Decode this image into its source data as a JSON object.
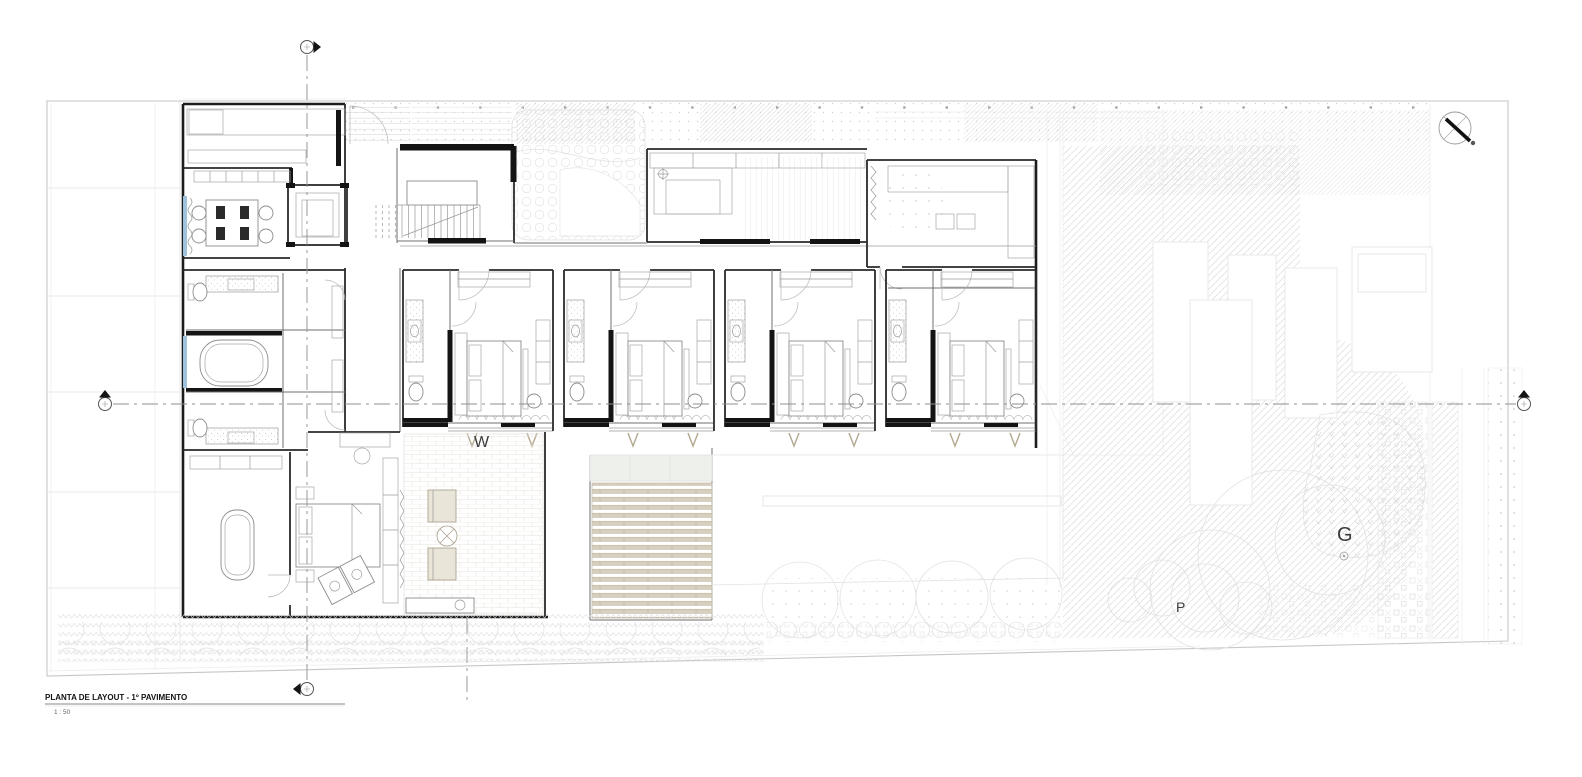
{
  "title_block": {
    "title": "PLANTA DE LAYOUT - 1º PAVIMENTO",
    "scale": "1 : 50"
  },
  "labels": {
    "garden": "G",
    "paving": "P",
    "winter_garden": "W"
  },
  "icons": {
    "north_indicator": "compass-icon",
    "section_cut_top": "section-cut-icon",
    "section_cut_bottom": "section-cut-icon",
    "section_cut_left": "section-cut-icon",
    "section_cut_right": "section-cut-icon"
  },
  "colors": {
    "walls": "#1c1c1c",
    "paper": "#ffffff",
    "boundary_gray": "#c6c6c6",
    "detail_gray": "#8c8c8c",
    "hatch_gray": "#dcdcdc",
    "glass_blue": "#9fc3dd",
    "wood_tan": "#b3a88f",
    "deck_slat": "#d8cfbf"
  }
}
